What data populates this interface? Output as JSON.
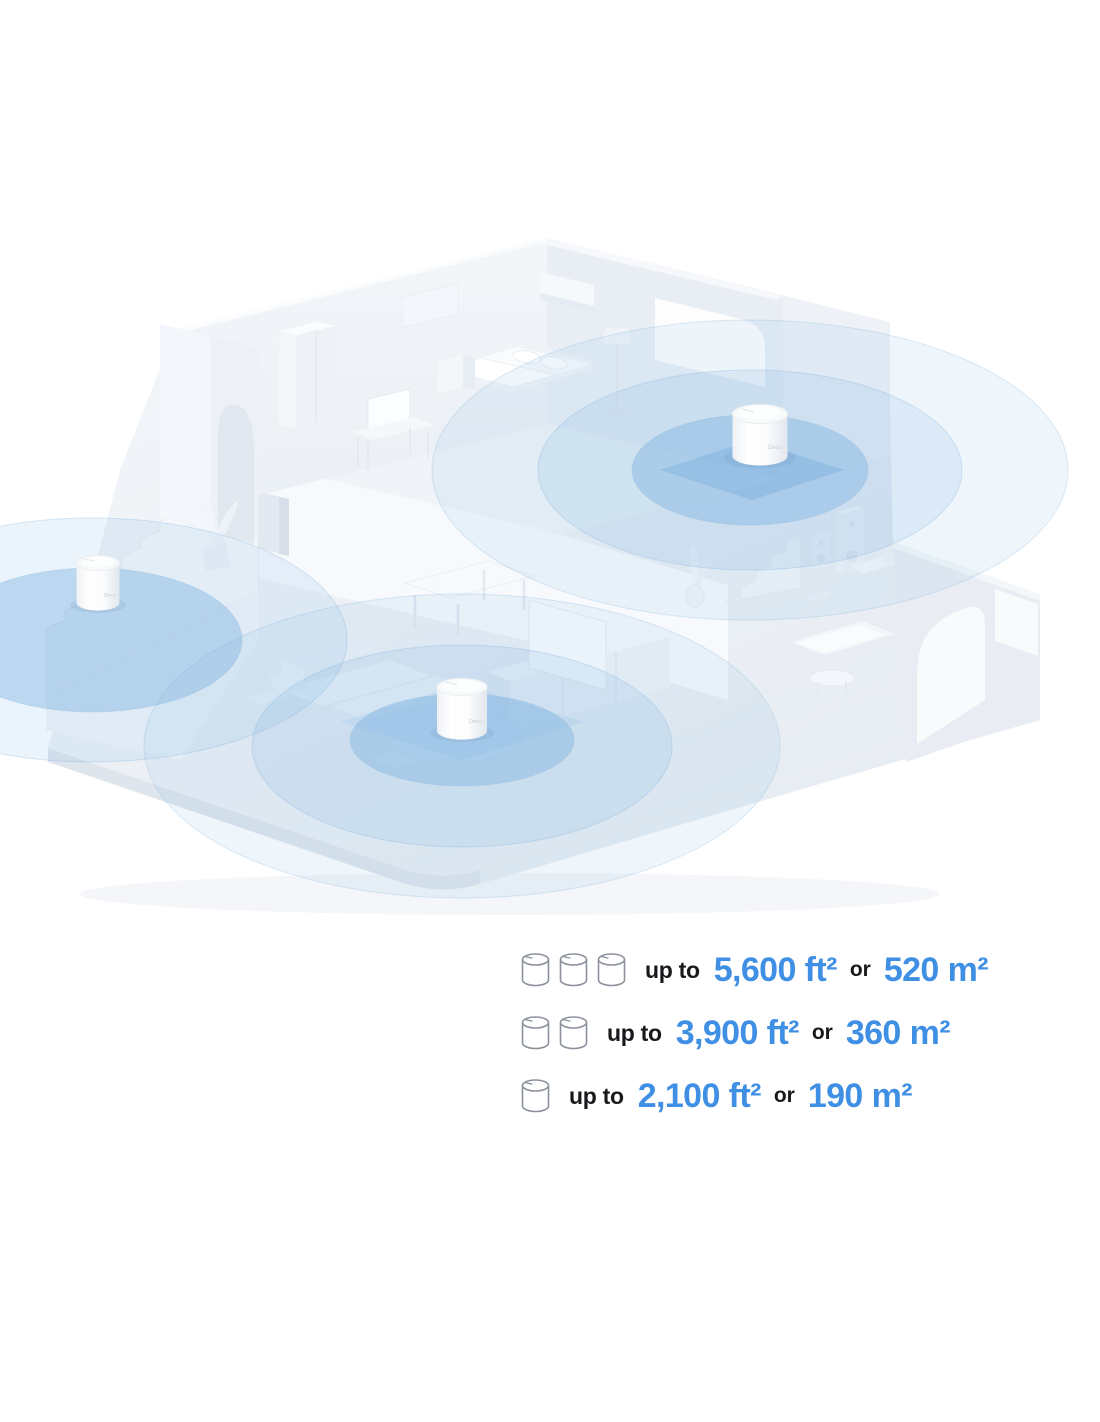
{
  "scene": {
    "device_label": "Deco",
    "deco_unit_count": 3,
    "ripple_color": "#79b1e0",
    "house_base_color": "#edf1f6"
  },
  "legend": {
    "text_color": "#17191c",
    "value_color": "#3f8fe5",
    "rows": [
      {
        "units": 3,
        "up_to_label": "up to",
        "ft_value": "5,600 ft²",
        "or_label": "or",
        "m_value": "520 m²"
      },
      {
        "units": 2,
        "up_to_label": "up to",
        "ft_value": "3,900 ft²",
        "or_label": "or",
        "m_value": "360 m²"
      },
      {
        "units": 1,
        "up_to_label": "up to",
        "ft_value": "2,100 ft²",
        "or_label": "or",
        "m_value": "190 m²"
      }
    ]
  }
}
